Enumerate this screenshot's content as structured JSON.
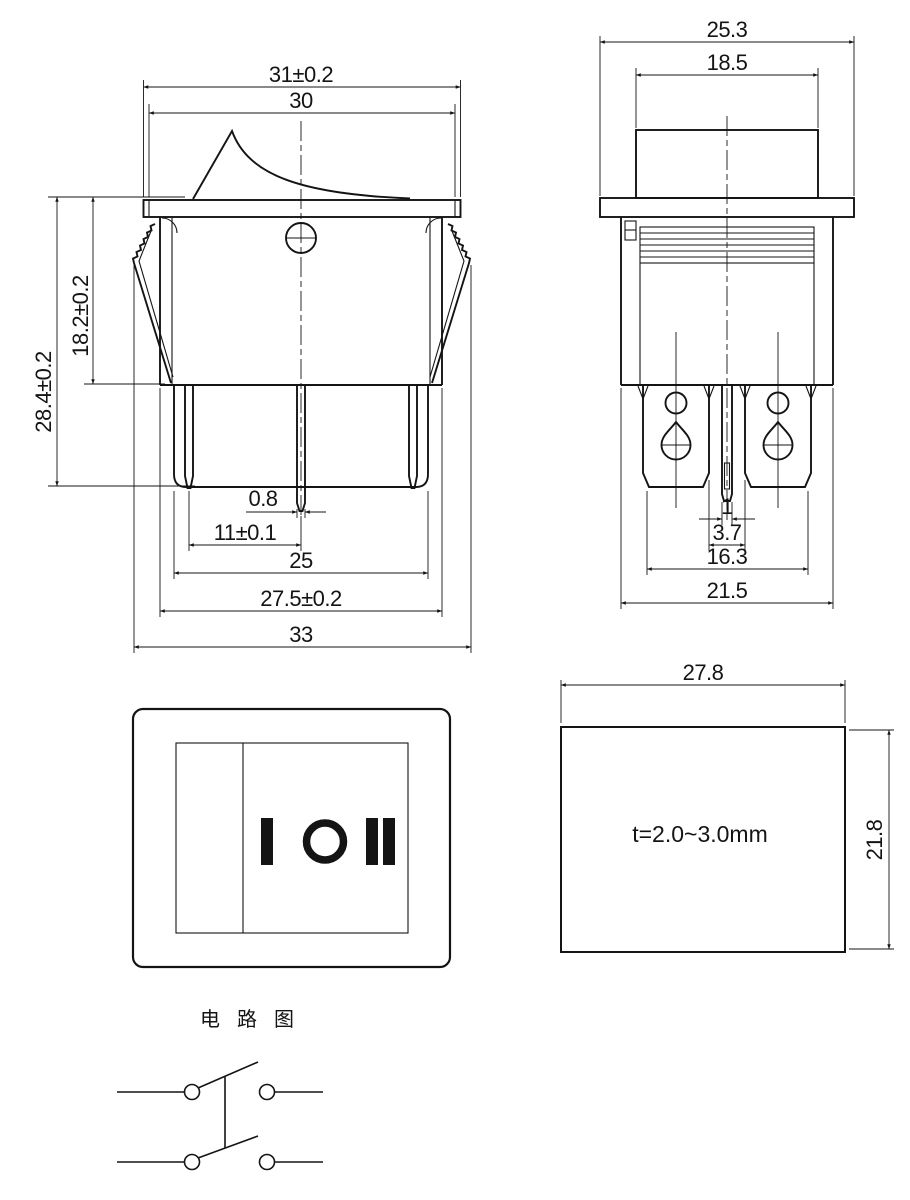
{
  "front_view": {
    "dim_flange_width": "31±0.2",
    "dim_opening_width": "30",
    "dim_mount_depth": "18.2±0.2",
    "dim_total_height": "28.4±0.2",
    "dim_pin_thickness": "0.8",
    "dim_pin_pitch": "11±0.1",
    "dim_base_width": "25",
    "dim_body_width": "27.5±0.2",
    "dim_clip_span": "33"
  },
  "side_view": {
    "dim_flange_depth": "25.3",
    "dim_rocker_depth": "18.5",
    "dim_pin_width": "1",
    "dim_pin_gap": "3.7",
    "dim_terminal_span": "16.3",
    "dim_body_depth": "21.5"
  },
  "face_view": {
    "markings": [
      "I",
      "O",
      "II"
    ]
  },
  "panel_cutout": {
    "dim_width": "27.8",
    "dim_height": "21.8",
    "panel_thickness_note": "t=2.0~3.0mm"
  },
  "circuit_diagram": {
    "title": "电 路 图"
  }
}
